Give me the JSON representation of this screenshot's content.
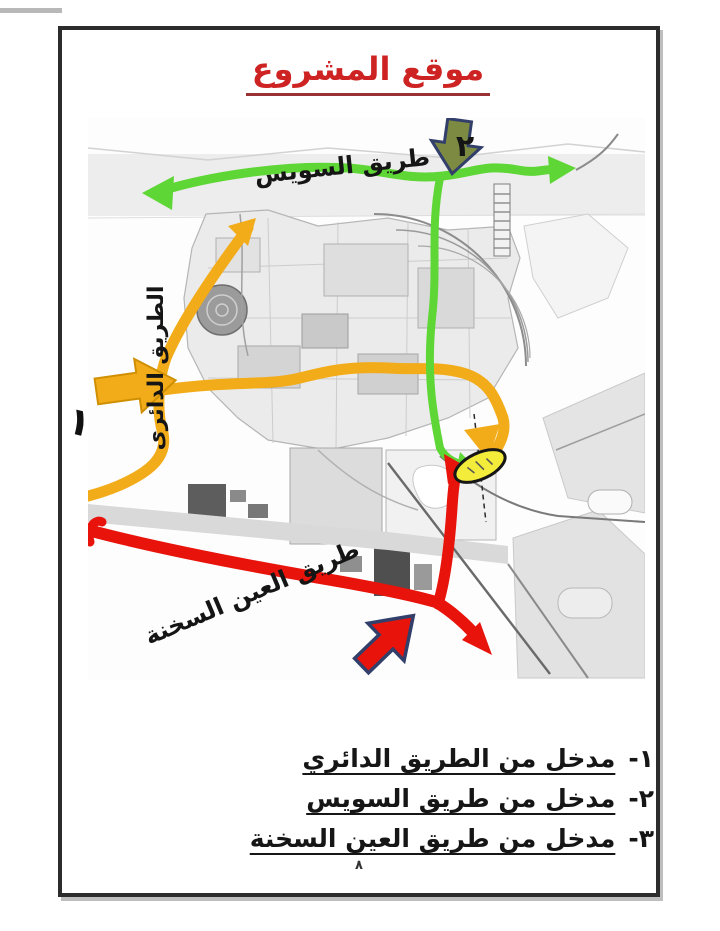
{
  "page": {
    "title": "موقع المشروع",
    "page_number": "٨"
  },
  "map": {
    "road_labels": {
      "suez": "طريق السويس",
      "ring": "الطريق الدائرى",
      "sokhna": "طريق العين السخنة"
    },
    "markers": {
      "one": "١",
      "two": "٢"
    },
    "colors": {
      "suez_road": "#5ed636",
      "ring_road": "#f3ac19",
      "ring_road_edge": "#cf8f00",
      "sokhna_road": "#e8130b",
      "site_marker": "#f3ec3a",
      "site_marker_edge": "#161616",
      "entrance2_arrow": "#7d8b42",
      "arrow_outline_navy": "#333f6b",
      "title_red": "#ce2323"
    }
  },
  "legend": {
    "items": [
      {
        "num": "١-",
        "text": "مدخل من الطريق الدائري"
      },
      {
        "num": "٢-",
        "text": "مدخل من طريق السويس"
      },
      {
        "num": "٣-",
        "text": "مدخل من طريق العين السخنة"
      }
    ]
  }
}
